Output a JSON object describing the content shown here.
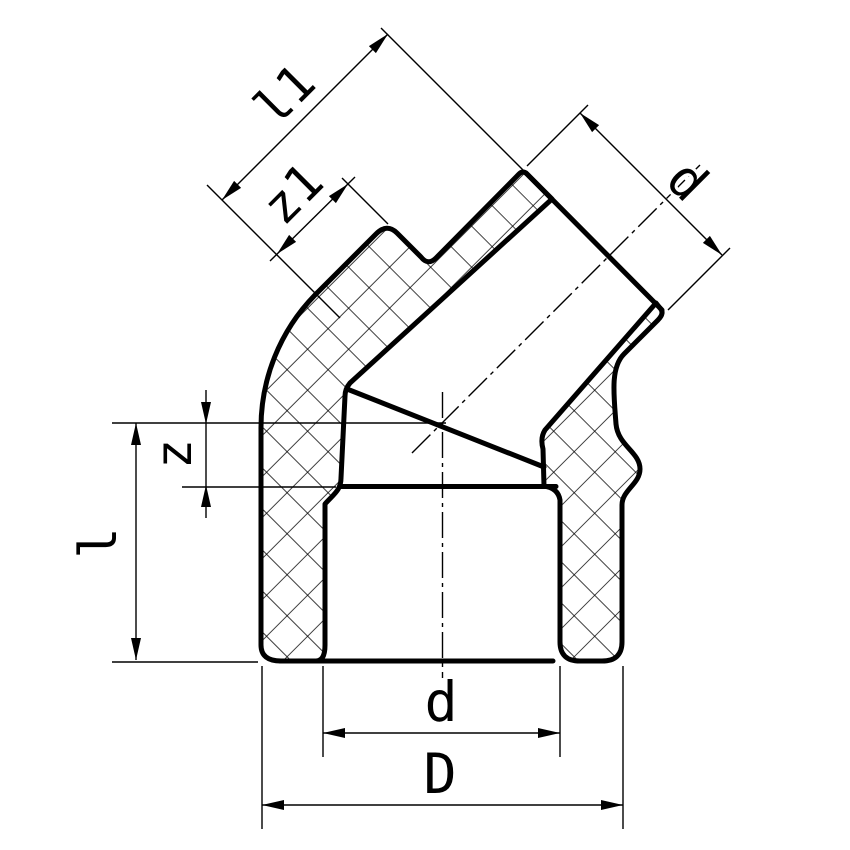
{
  "figure": {
    "background": "#ffffff",
    "line_color": "#000000"
  },
  "labels": {
    "branch_length": "l1",
    "branch_offset": "z1",
    "branch_bore": "d",
    "body_offset": "z",
    "body_length": "l",
    "bore_diameter": "d",
    "outer_diameter": "D"
  }
}
